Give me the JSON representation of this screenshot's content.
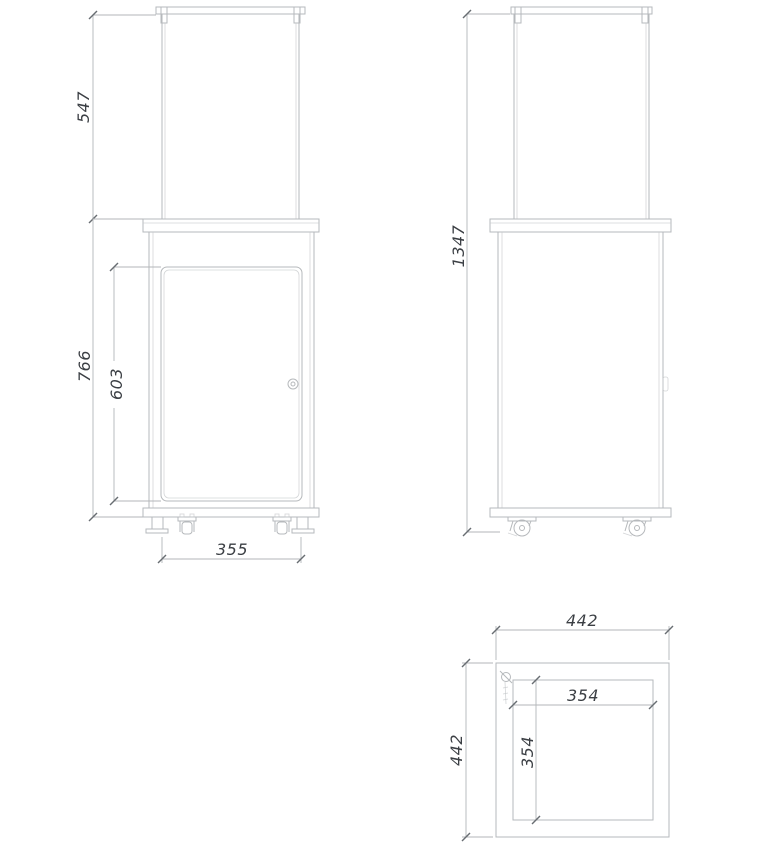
{
  "drawing_type": "technical-orthographic-views",
  "views": {
    "front": {
      "name": "front view",
      "dimensions": {
        "glass_height": "547",
        "body_height": "766",
        "door_height": "603",
        "feet_spacing": "355"
      }
    },
    "side": {
      "name": "side view",
      "dimensions": {
        "total_height": "1347"
      }
    },
    "top": {
      "name": "top view",
      "dimensions": {
        "outer_width": "442",
        "outer_depth": "442",
        "inner_width": "354",
        "inner_depth": "354"
      }
    }
  },
  "colors": {
    "background": "#ffffff",
    "object_line": "#b6b9bc",
    "dimension_line": "#b3b6b9",
    "tick": "#686d72",
    "dimension_text": "#3b3f44"
  }
}
